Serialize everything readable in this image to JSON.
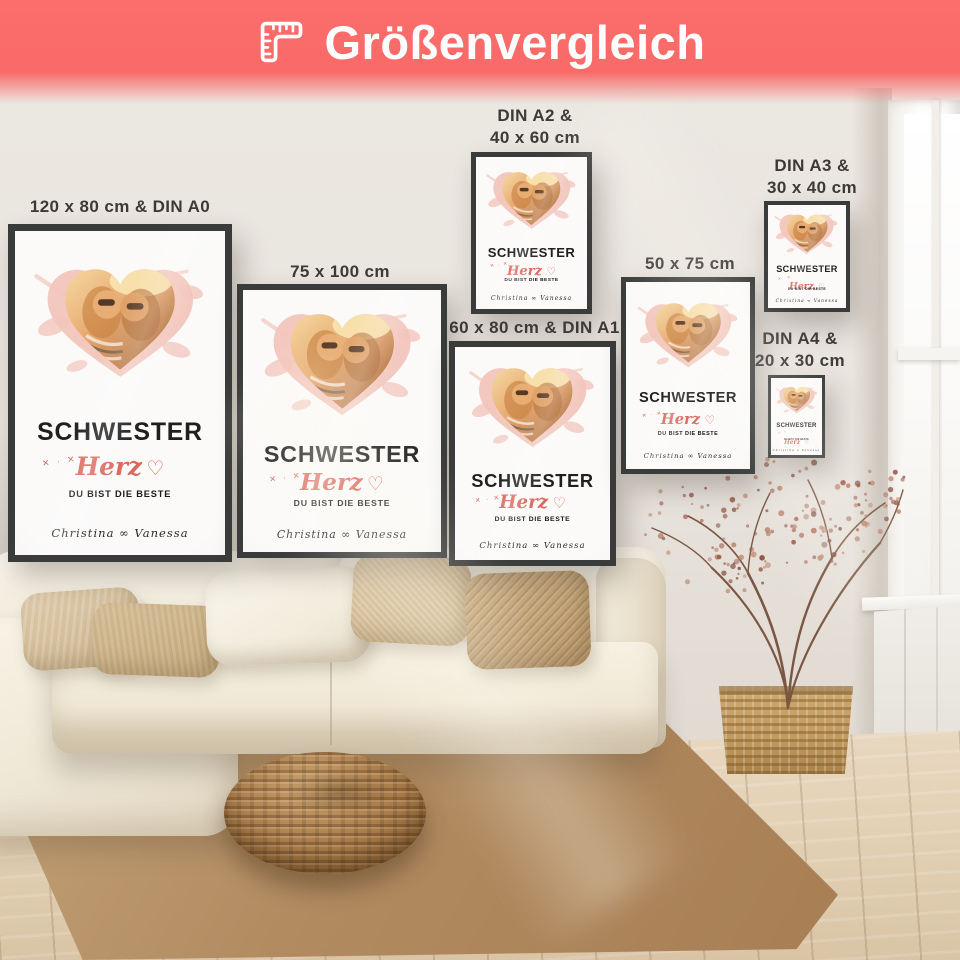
{
  "header": {
    "title": "Größenvergleich",
    "icon": "ruler-square-icon",
    "background_color": "#fa6e6c",
    "text_color": "#ffffff"
  },
  "poster_design": {
    "title": "SCHWESTER",
    "script_word": "Herz",
    "heart_symbol": "♡",
    "sparkles": "✕ · ✕",
    "tagline": "DU BIST DIE BESTE",
    "names": "Christina ∞ Vanessa",
    "accent_color": "#d9695d",
    "splash_color": "#f2c6bc",
    "frame_color": "#3a3c3b"
  },
  "size_labels": [
    {
      "id": "120x80-din-a0",
      "label": "120 x 80 cm & DIN A0"
    },
    {
      "id": "75x100",
      "label": "75 x 100 cm"
    },
    {
      "id": "din-a2-40x60",
      "label": "DIN A2 &\n40 x 60 cm"
    },
    {
      "id": "60x80-din-a1",
      "label": "60 x 80 cm & DIN A1"
    },
    {
      "id": "50x75",
      "label": "50 x 75 cm"
    },
    {
      "id": "din-a3-30x40",
      "label": "DIN A3 &\n30 x 40 cm"
    },
    {
      "id": "din-a4-20x30",
      "label": "DIN A4 &\n20 x 30 cm"
    }
  ]
}
